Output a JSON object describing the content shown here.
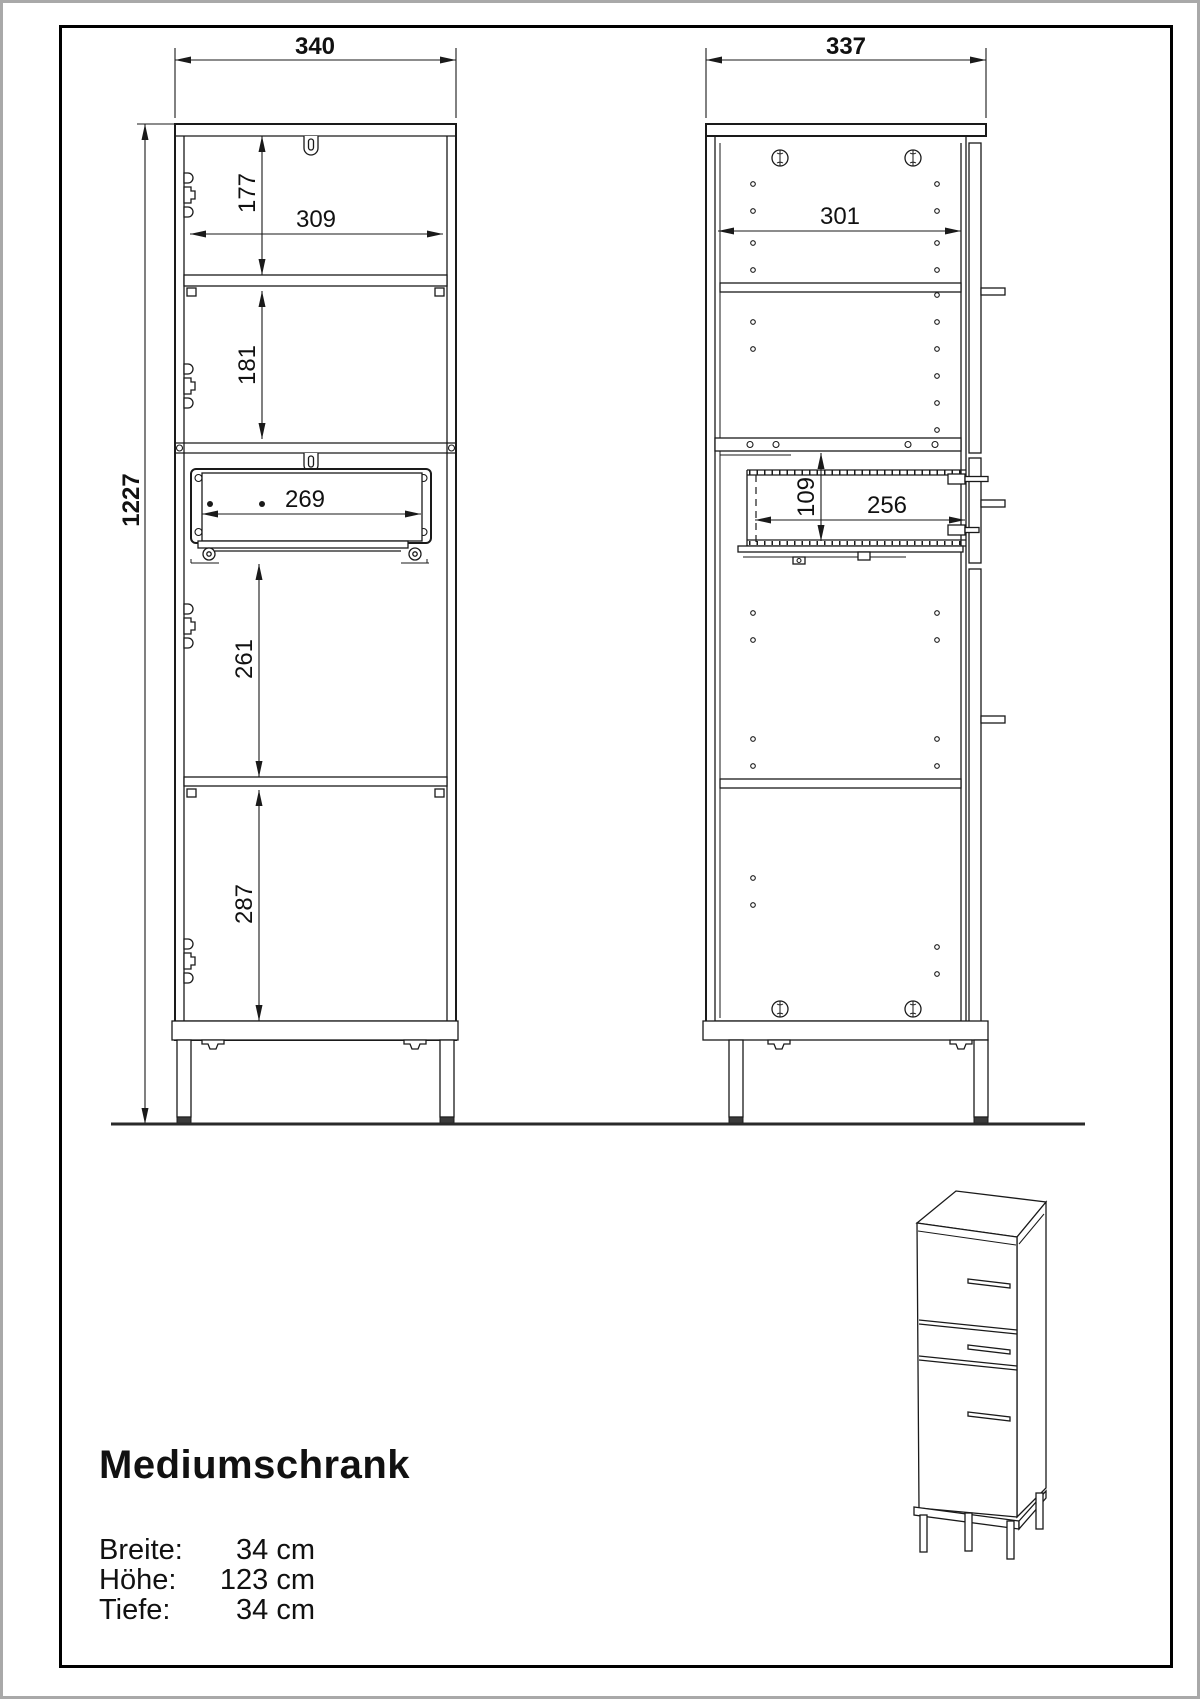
{
  "drawing": {
    "front_view": {
      "dims": {
        "width": "340",
        "height": "1227",
        "top_section_height": "177",
        "inner_width": "309",
        "second_section_height": "181",
        "drawer_inner_width": "269",
        "third_section_height": "261",
        "bottom_section_height": "287"
      }
    },
    "side_view": {
      "dims": {
        "depth": "337",
        "inner_depth": "301",
        "drawer_height": "109",
        "drawer_depth": "256"
      }
    }
  },
  "info": {
    "title": "Mediumschrank",
    "specs": [
      {
        "label": "Breite:",
        "value": "34 cm"
      },
      {
        "label": "Höhe:",
        "value": "123 cm"
      },
      {
        "label": "Tiefe:",
        "value": "34 cm"
      }
    ]
  },
  "colors": {
    "line": "#1a1a1a",
    "frame": "#000000",
    "page_border": "#a9a9a9",
    "background": "#ffffff"
  }
}
